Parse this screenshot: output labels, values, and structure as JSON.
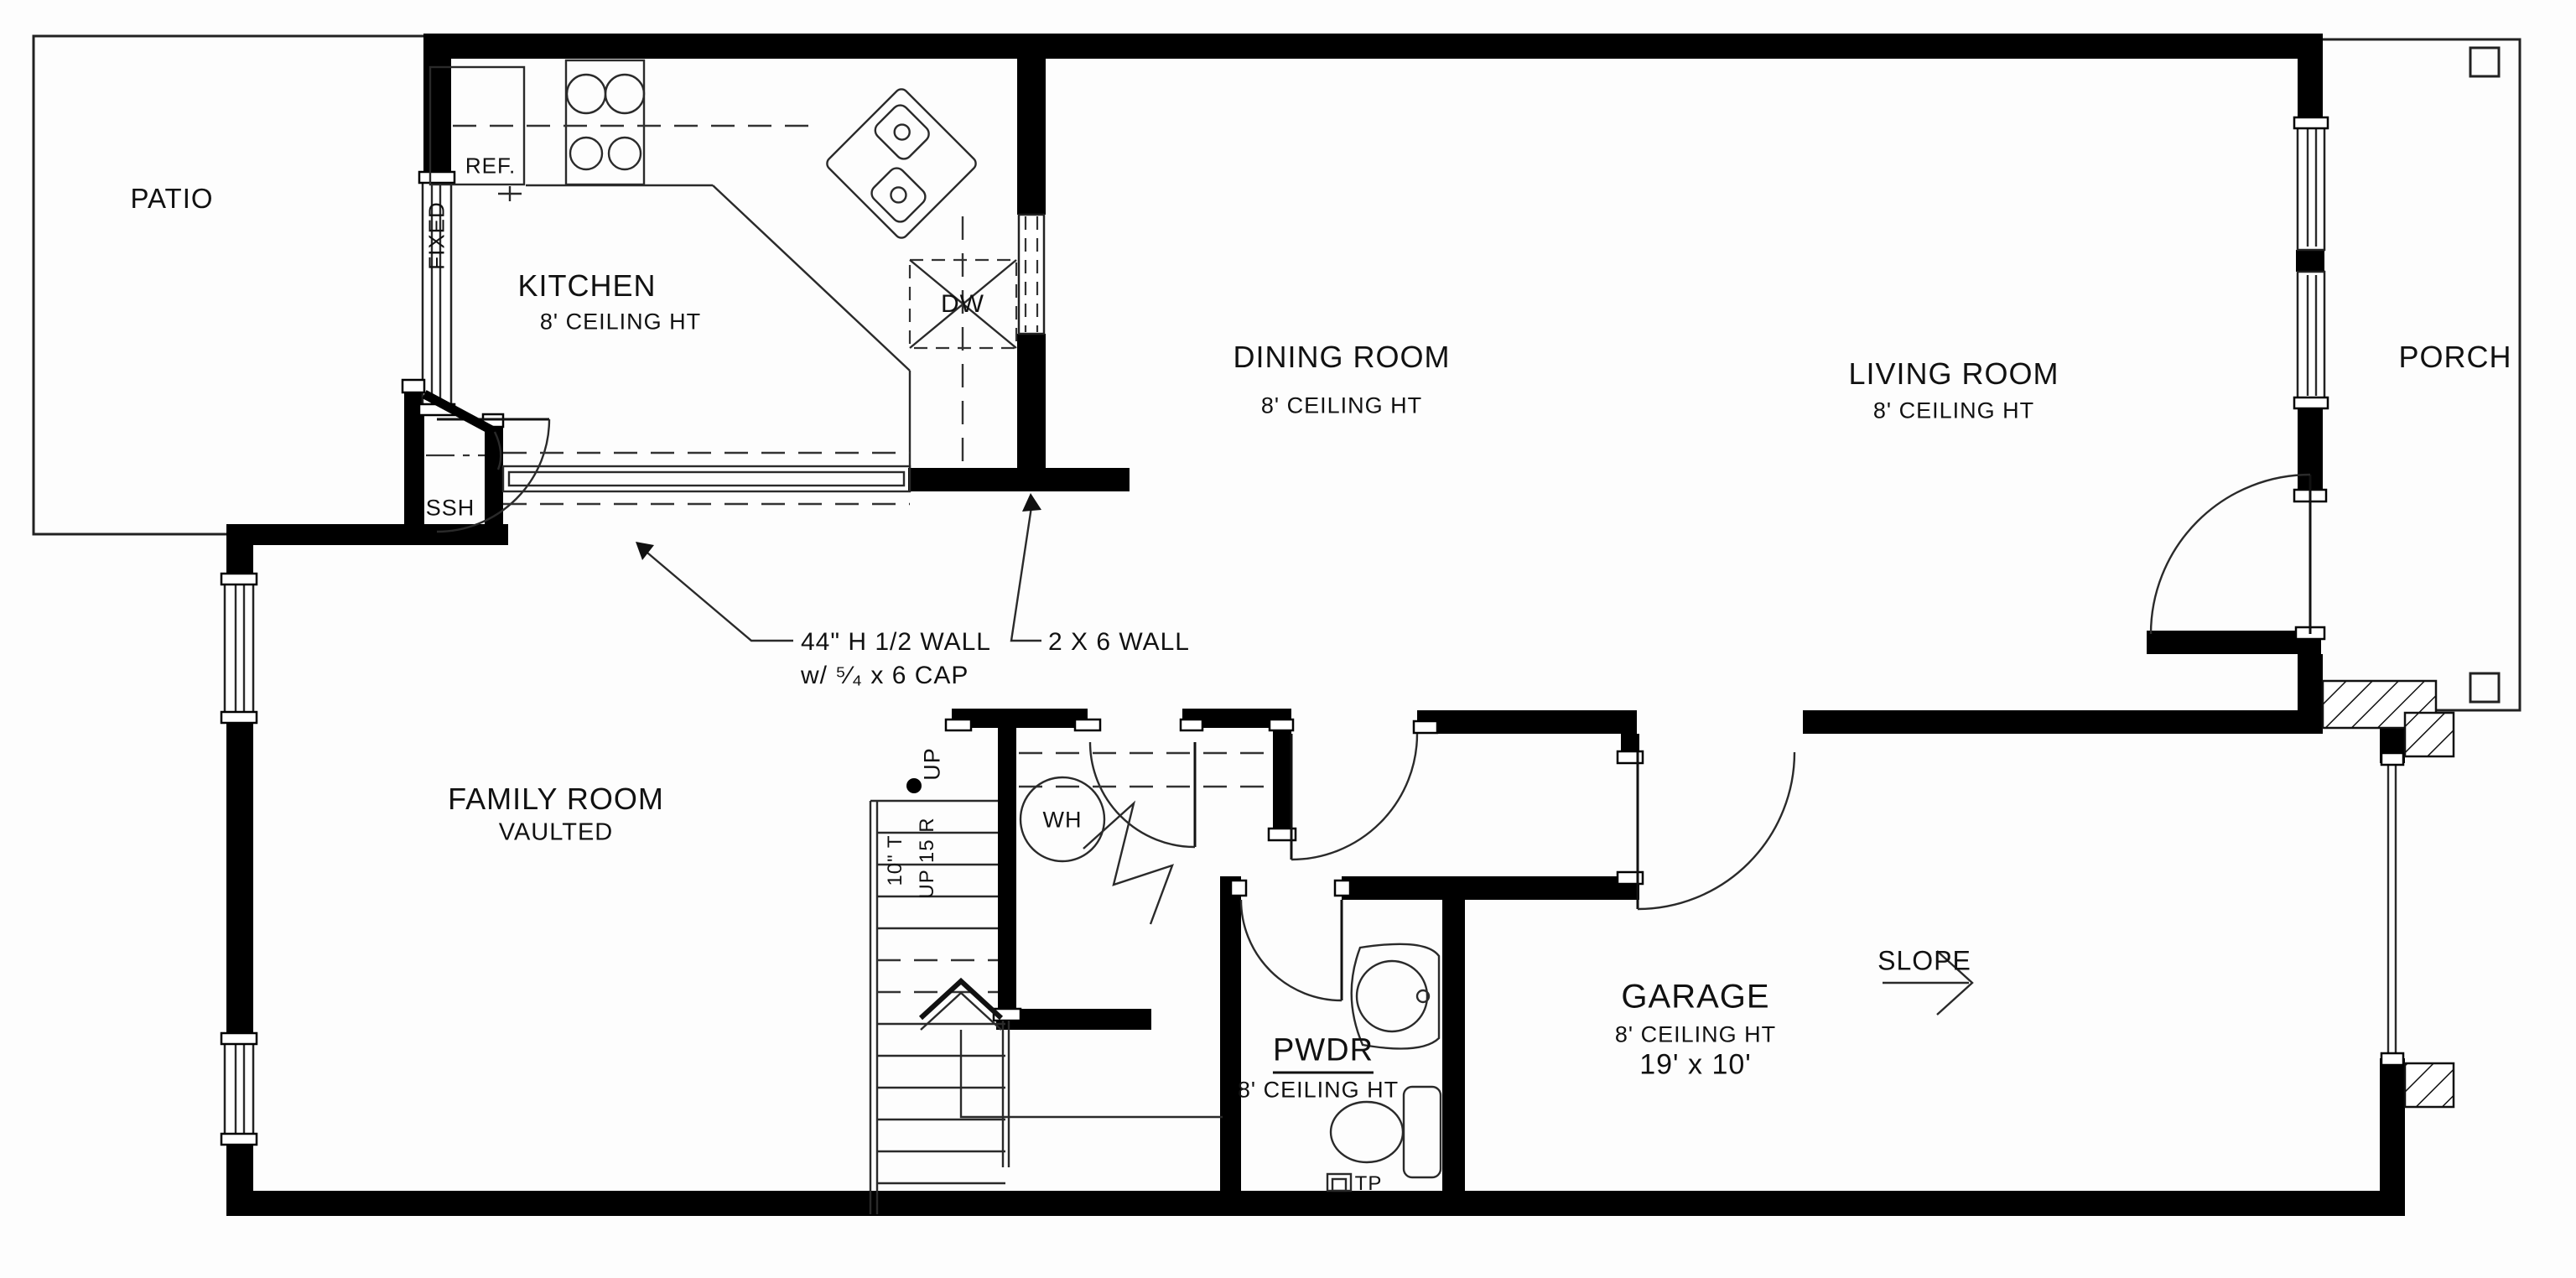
{
  "rooms": {
    "patio": {
      "name": "PATIO"
    },
    "kitchen": {
      "name": "KITCHEN",
      "ceiling": "8' CEILING HT"
    },
    "dining": {
      "name": "DINING ROOM",
      "ceiling": "8' CEILING HT"
    },
    "living": {
      "name": "LIVING ROOM",
      "ceiling": "8' CEILING HT"
    },
    "porch": {
      "name": "PORCH"
    },
    "family": {
      "name": "FAMILY ROOM",
      "sub": "VAULTED"
    },
    "garage": {
      "name": "GARAGE",
      "ceiling": "8' CEILING HT",
      "size": "19' x 10'"
    },
    "powder": {
      "name": "PWDR",
      "ceiling": "8' CEILING HT"
    }
  },
  "fixtures": {
    "refrigerator": "REF.",
    "fixed_window": "FIXED",
    "dishwasher": "DW",
    "ssh_closet": "SSH",
    "water_heater": "WH",
    "toilet_paper": "TP",
    "stair_up": "UP",
    "stair_tread": "10\" T",
    "stair_riser": "UP 15 R",
    "slope": "SLOPE"
  },
  "annotations": {
    "half_wall_line1": "44\" H 1/2 WALL",
    "half_wall_line2": "w/ ⁵⁄₄ x 6 CAP",
    "wall_2x6": "2 X 6 WALL"
  },
  "colors": {
    "wall": "#000000",
    "line": "#222222",
    "background": "#fdfdfd"
  }
}
